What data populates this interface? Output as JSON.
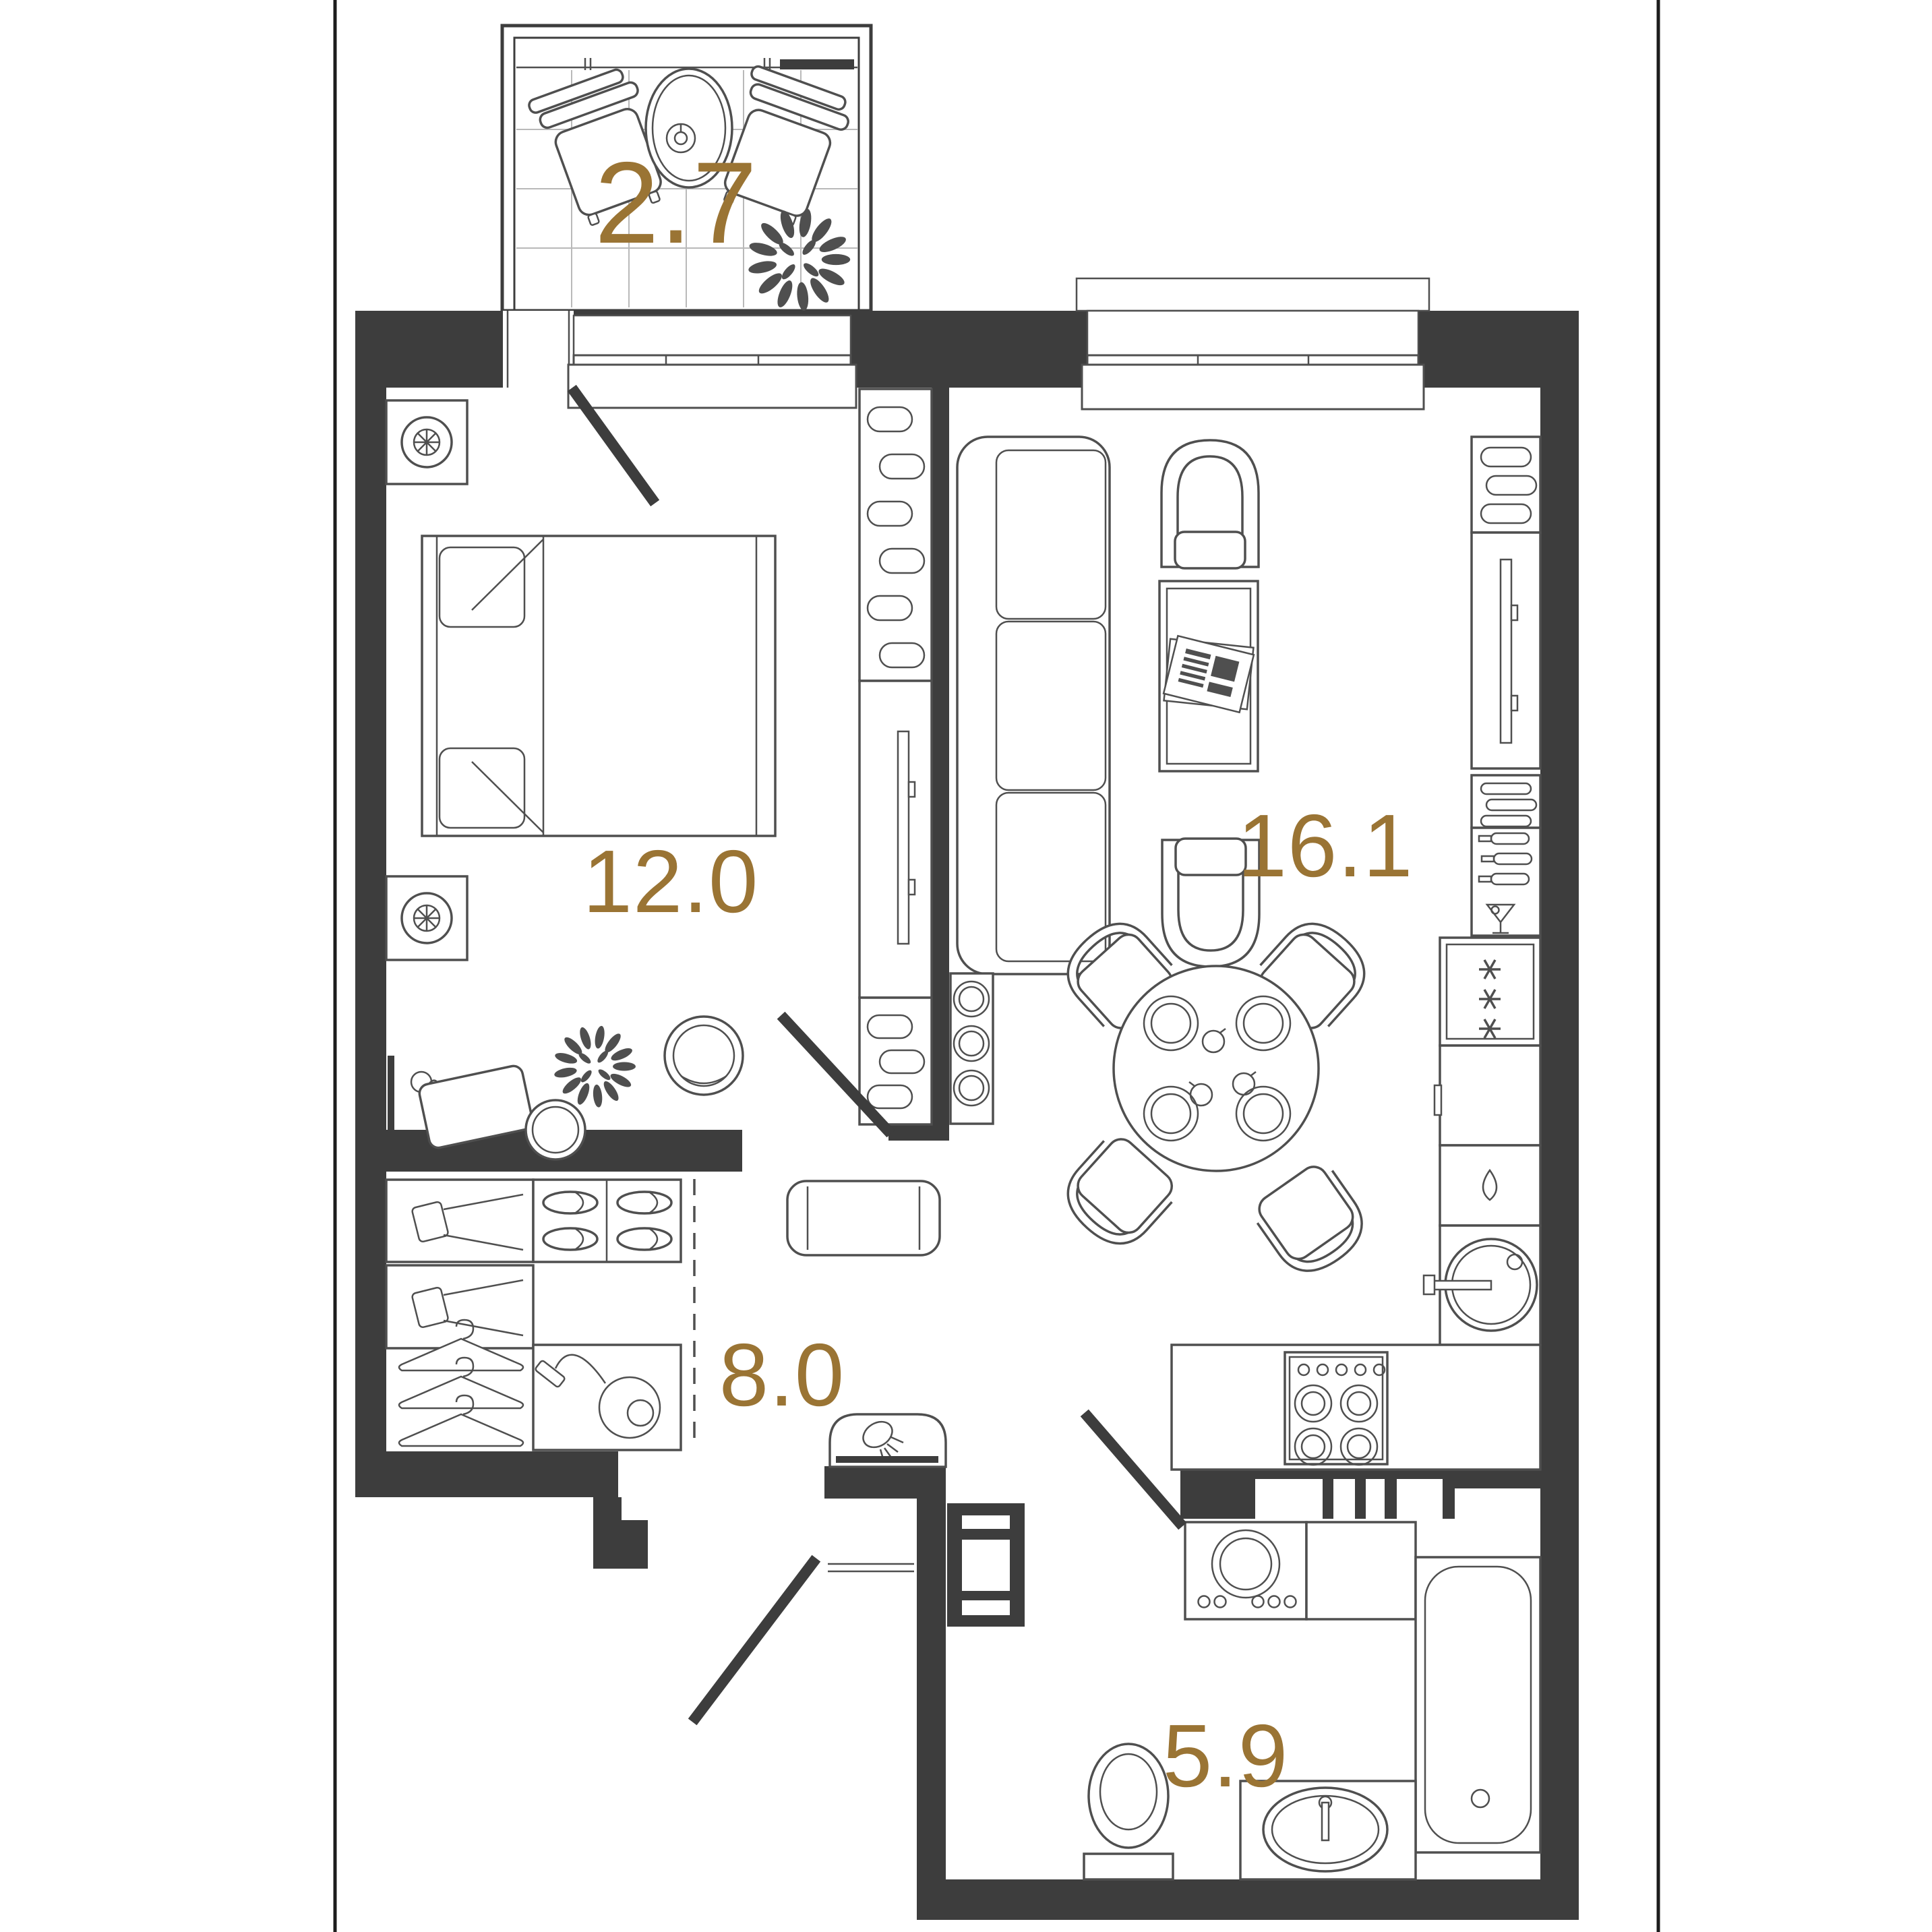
{
  "colors": {
    "wall": "#3d3d3d",
    "line": "#4f4f4f",
    "line_soft": "#8a8a8a",
    "label": "#9a7434",
    "grid": "#b9b9b9",
    "frame": "#1c1c1c",
    "bg": "#ffffff"
  },
  "rooms": {
    "balcony": {
      "area": "2.7"
    },
    "bedroom": {
      "area": "12.0"
    },
    "living_kitchen": {
      "area": "16.1"
    },
    "hallway": {
      "area": "8.0"
    },
    "bathroom": {
      "area": "5.9"
    }
  }
}
